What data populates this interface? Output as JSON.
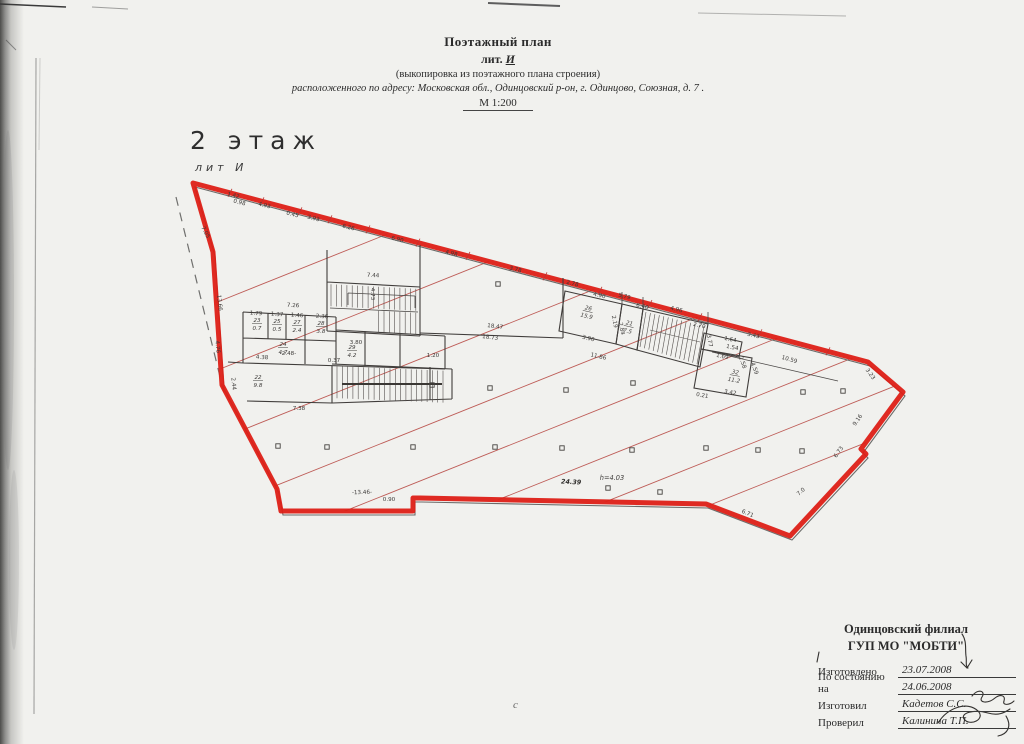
{
  "header": {
    "title": "Поэтажный план",
    "lit_prefix": "лит.",
    "lit_letter": "И",
    "subtitle": "(выкопировка из поэтажного плана строения)",
    "address": "расположенного по адресу: Московская обл., Одинцовский р-он, г. Одинцово, Союзная, д. 7 .",
    "scale": "М 1:200"
  },
  "plan": {
    "floor_label": "2 этаж",
    "lit_label": "лит И",
    "outline_color": "#dd1f16",
    "hatch_color": "#b5423c",
    "dimensions": [
      {
        "t": "1.42",
        "x": 233,
        "y": 197,
        "r": 14
      },
      {
        "t": "0.98",
        "x": 239,
        "y": 204,
        "r": 14
      },
      {
        "t": "4.93",
        "x": 264,
        "y": 207,
        "r": 14
      },
      {
        "t": "0.45",
        "x": 292,
        "y": 216,
        "r": 14
      },
      {
        "t": "3.93",
        "x": 313,
        "y": 220,
        "r": 14
      },
      {
        "t": "6.26",
        "x": 348,
        "y": 229,
        "r": 14
      },
      {
        "t": "6.90",
        "x": 397,
        "y": 241,
        "r": 14
      },
      {
        "t": "4.98",
        "x": 451,
        "y": 255,
        "r": 14
      },
      {
        "t": "3.78",
        "x": 515,
        "y": 271,
        "r": 14
      },
      {
        "t": "2.78",
        "x": 572,
        "y": 285,
        "r": 14
      },
      {
        "t": "5.79",
        "x": 624,
        "y": 298,
        "r": 14
      },
      {
        "t": "4.96",
        "x": 676,
        "y": 311,
        "r": 14
      },
      {
        "t": "10.59",
        "x": 789,
        "y": 361,
        "r": 16
      },
      {
        "t": "3.23",
        "x": 869,
        "y": 375,
        "r": 55
      },
      {
        "t": "9.16",
        "x": 859,
        "y": 421,
        "r": -55
      },
      {
        "t": "6.73",
        "x": 840,
        "y": 453,
        "r": -55
      },
      {
        "t": "7.0",
        "x": 802,
        "y": 493,
        "r": -40
      },
      {
        "t": "6.71",
        "x": 747,
        "y": 515,
        "r": 22
      },
      {
        "t": "24.39",
        "x": 571,
        "y": 484,
        "r": 3,
        "s": "bold"
      },
      {
        "t": "h=4.03",
        "x": 612,
        "y": 480,
        "r": 0,
        "s": "italic"
      },
      {
        "t": "-13.46-",
        "x": 362,
        "y": 494,
        "r": -2
      },
      {
        "t": "0.90",
        "x": 389,
        "y": 501,
        "r": 0
      },
      {
        "t": "7.05",
        "x": 204,
        "y": 233,
        "r": 62
      },
      {
        "t": "13.66",
        "x": 218,
        "y": 303,
        "r": 84
      },
      {
        "t": "4.76",
        "x": 216,
        "y": 347,
        "r": 84
      },
      {
        "t": "2.44",
        "x": 232,
        "y": 384,
        "r": 84
      },
      {
        "t": "7.44",
        "x": 373,
        "y": 277,
        "r": 3
      },
      {
        "t": "4.73",
        "x": 371,
        "y": 294,
        "r": 90
      },
      {
        "t": "18.47",
        "x": 495,
        "y": 328,
        "r": 7
      },
      {
        "t": "18.73",
        "x": 490,
        "y": 339,
        "r": 7
      },
      {
        "t": "4.90",
        "x": 599,
        "y": 297,
        "r": 13
      },
      {
        "t": "6.40",
        "x": 642,
        "y": 308,
        "r": 13
      },
      {
        "t": "3.90",
        "x": 588,
        "y": 340,
        "r": 13
      },
      {
        "t": "11.86",
        "x": 598,
        "y": 358,
        "r": 13
      },
      {
        "t": "2.19",
        "x": 613,
        "y": 322,
        "r": 78
      },
      {
        "t": "2.84",
        "x": 620,
        "y": 329,
        "r": 78
      },
      {
        "t": "2.70",
        "x": 699,
        "y": 327,
        "r": 13
      },
      {
        "t": "3.77",
        "x": 708,
        "y": 341,
        "r": 80
      },
      {
        "t": "1.64",
        "x": 730,
        "y": 341,
        "r": 12
      },
      {
        "t": "1.54",
        "x": 732,
        "y": 349,
        "r": 12
      },
      {
        "t": "1.69",
        "x": 722,
        "y": 358,
        "r": 12
      },
      {
        "t": "2.58",
        "x": 741,
        "y": 363,
        "r": 70
      },
      {
        "t": "4.59",
        "x": 753,
        "y": 369,
        "r": 70
      },
      {
        "t": "3.42",
        "x": 730,
        "y": 394,
        "r": 10
      },
      {
        "t": "0.21",
        "x": 702,
        "y": 397,
        "r": 10
      },
      {
        "t": "3.43",
        "x": 753,
        "y": 337,
        "r": 13
      },
      {
        "t": "7.26",
        "x": 293,
        "y": 307,
        "r": 3
      },
      {
        "t": "1.79",
        "x": 256,
        "y": 315,
        "r": 3
      },
      {
        "t": "1.37",
        "x": 277,
        "y": 316,
        "r": 3
      },
      {
        "t": "1.46",
        "x": 297,
        "y": 317,
        "r": 3
      },
      {
        "t": "2.36",
        "x": 322,
        "y": 318,
        "r": 3
      },
      {
        "t": "4.38",
        "x": 262,
        "y": 359,
        "r": 3
      },
      {
        "t": "-2.48-",
        "x": 288,
        "y": 355,
        "r": 0
      },
      {
        "t": "3.80",
        "x": 356,
        "y": 344,
        "r": 0
      },
      {
        "t": "1.20",
        "x": 433,
        "y": 357,
        "r": 0
      },
      {
        "t": "0.37",
        "x": 334,
        "y": 362,
        "r": 0
      },
      {
        "t": "7.38",
        "x": 299,
        "y": 410,
        "r": 0
      }
    ],
    "room_labels": [
      {
        "num": "23",
        "area": "0.7",
        "x": 257,
        "y": 322,
        "r": 0
      },
      {
        "num": "25",
        "area": "0.5",
        "x": 277,
        "y": 323,
        "r": 0
      },
      {
        "num": "27",
        "area": "2.4",
        "x": 297,
        "y": 324,
        "r": 0
      },
      {
        "num": "28",
        "area": "3.8",
        "x": 321,
        "y": 325,
        "r": 0
      },
      {
        "num": "24",
        "area": "4.7",
        "x": 283,
        "y": 346,
        "r": 0
      },
      {
        "num": "29",
        "area": "4.2",
        "x": 352,
        "y": 349,
        "r": 0
      },
      {
        "num": "22",
        "area": "9.8",
        "x": 258,
        "y": 379,
        "r": 0
      },
      {
        "num": "26",
        "area": "15.9",
        "x": 588,
        "y": 310,
        "r": 13
      },
      {
        "num": "21",
        "area": "7.5",
        "x": 629,
        "y": 325,
        "r": 13
      },
      {
        "num": "32",
        "area": "11.2",
        "x": 735,
        "y": 374,
        "r": 10
      }
    ],
    "columns": [
      [
        498,
        284
      ],
      [
        432,
        385
      ],
      [
        490,
        388
      ],
      [
        566,
        390
      ],
      [
        633,
        383
      ],
      [
        803,
        392
      ],
      [
        843,
        391
      ],
      [
        278,
        446
      ],
      [
        327,
        447
      ],
      [
        413,
        447
      ],
      [
        495,
        447
      ],
      [
        562,
        448
      ],
      [
        632,
        450
      ],
      [
        706,
        448
      ],
      [
        758,
        450
      ],
      [
        802,
        451
      ],
      [
        608,
        488
      ],
      [
        660,
        492
      ]
    ]
  },
  "title_block": {
    "org_line1": "Одинцовский филиал",
    "org_line2": "ГУП МО \"МОБТИ\"",
    "rows": [
      {
        "label": "Изготовлено",
        "value": "23.07.2008"
      },
      {
        "label": "По состоянию на",
        "value": "24.06.2008"
      },
      {
        "label": "Изготовил",
        "value": "Кадетов С.С."
      },
      {
        "label": "Проверил",
        "value": "Калинина Т.П."
      }
    ]
  },
  "artifacts": {
    "bottom_mark": "с"
  }
}
